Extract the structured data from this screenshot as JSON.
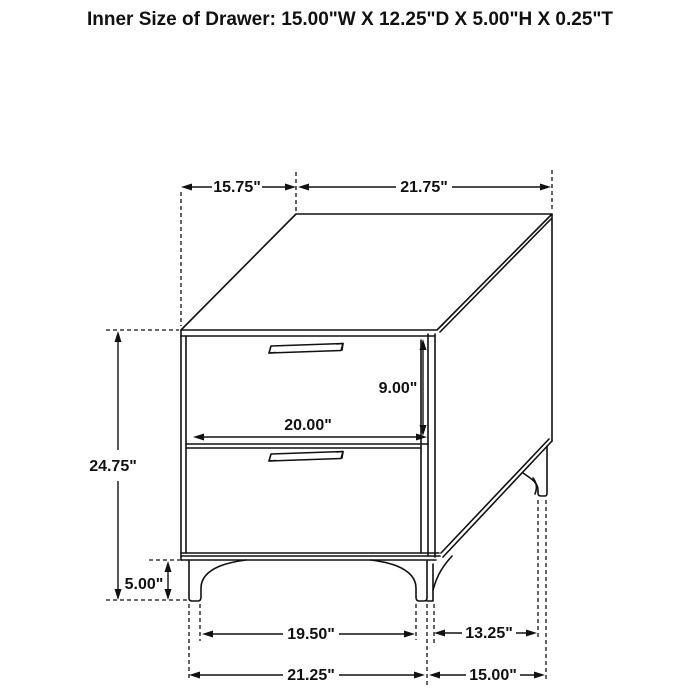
{
  "title": "Inner Size of Drawer: 15.00\"W X 12.25\"D X 5.00\"H X 0.25\"T",
  "figure": {
    "description": "Isometric black-and-white line drawing of a two-drawer nightstand with bracket legs and bar handles, annotated with dimension lines"
  },
  "colors": {
    "line": "#111111",
    "background": "#ffffff"
  },
  "dimensions": {
    "top_depth": "15.75\"",
    "top_width": "21.75\"",
    "overall_height": "24.75\"",
    "drawer_front_height": "9.00\"",
    "drawer_front_width": "20.00\"",
    "leg_height": "5.00\"",
    "front_leg_inner_span": "19.50\"",
    "side_leg_span": "13.25\"",
    "base_front_width": "21.25\"",
    "base_side_depth": "15.00\""
  }
}
